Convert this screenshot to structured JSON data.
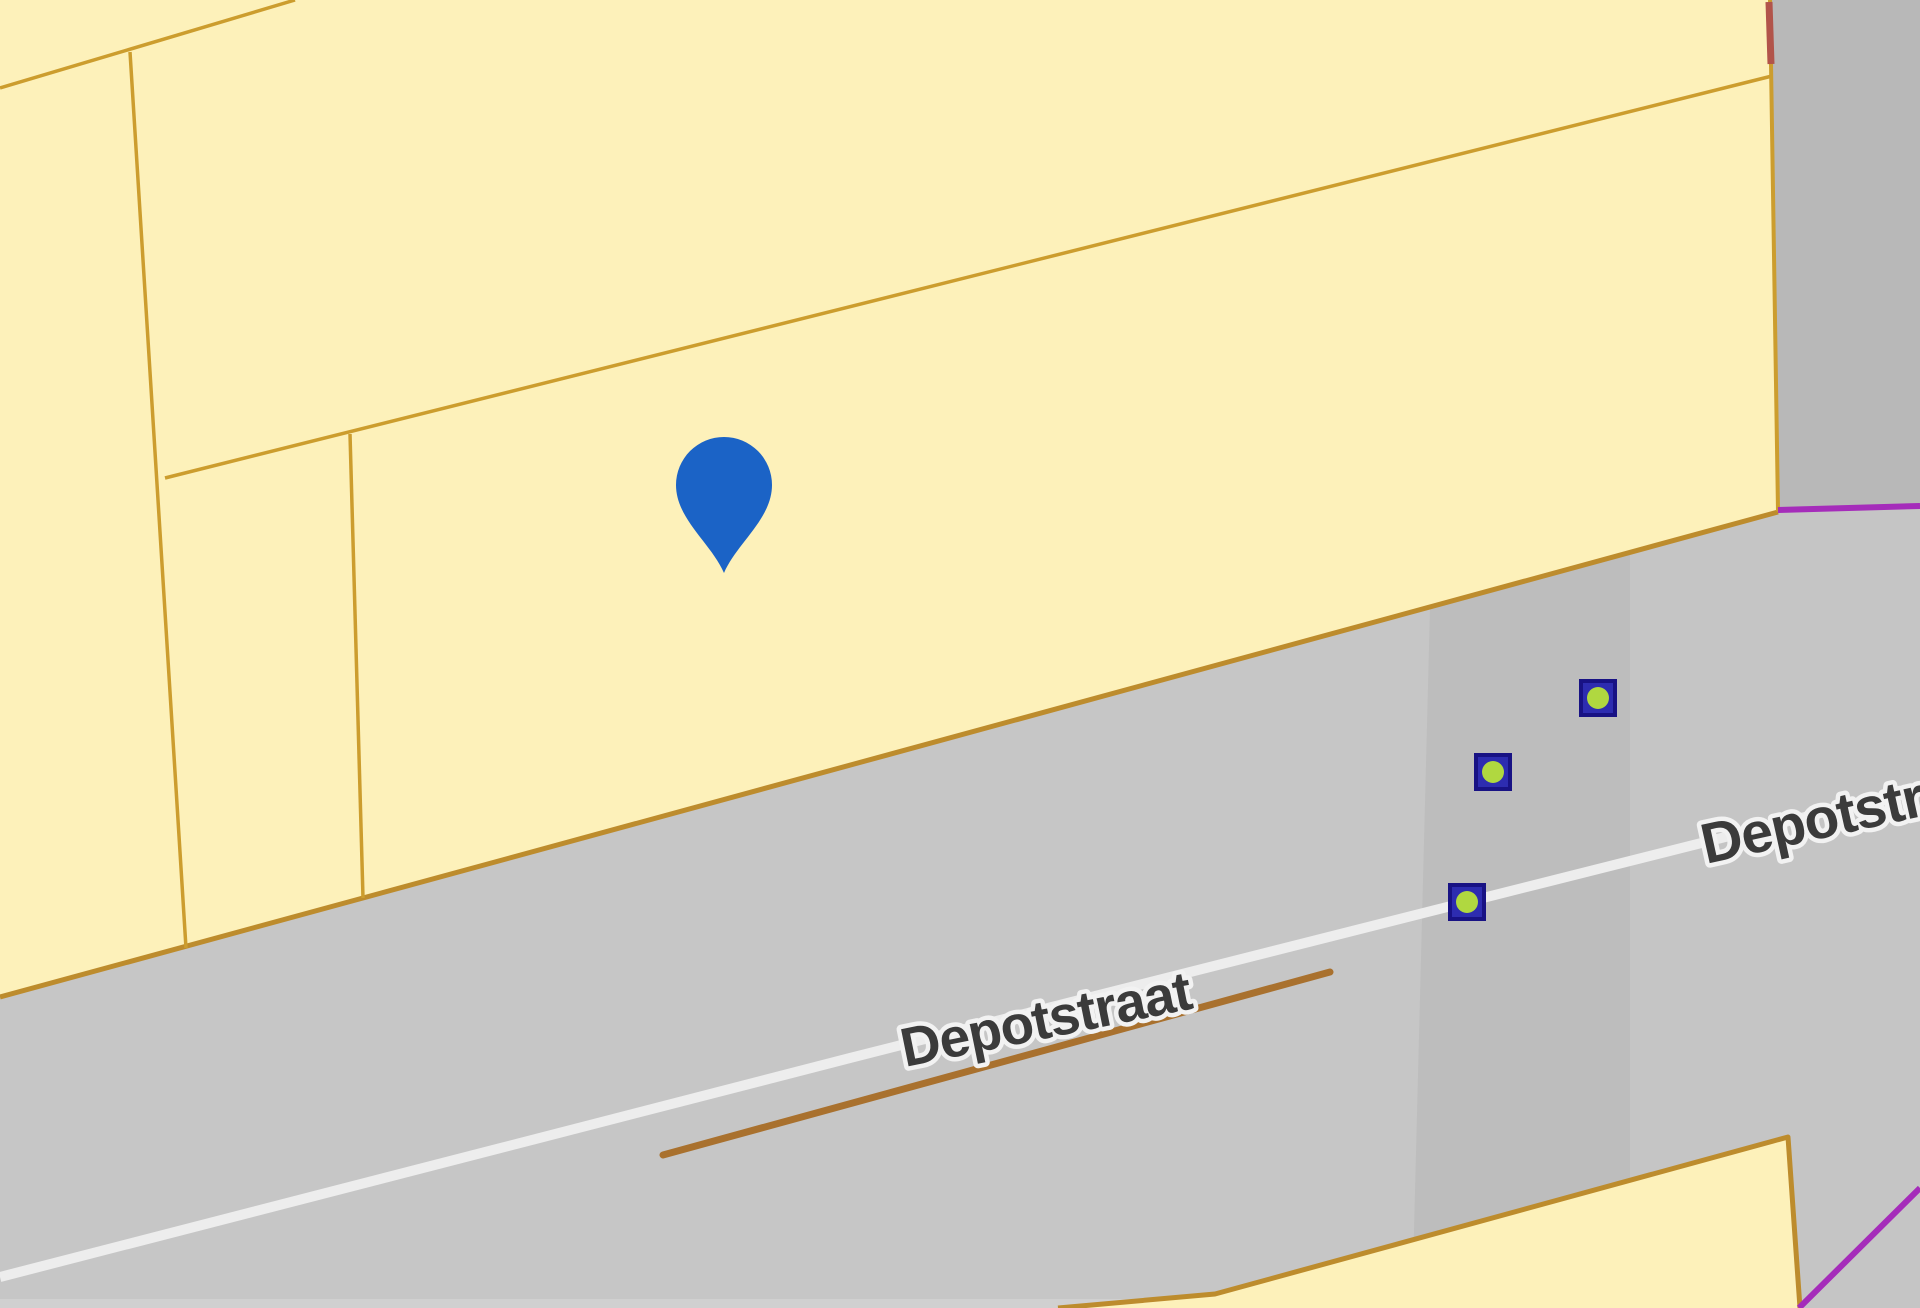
{
  "map": {
    "street_labels": [
      {
        "text": "Depotstraat",
        "x": 905,
        "y": 1067,
        "angle": -11.5
      },
      {
        "text": "Depotstraat",
        "x": 1706,
        "y": 864,
        "angle": -12.5
      }
    ],
    "pin": {
      "x": 724,
      "y": 573
    },
    "node_markers": [
      {
        "x": 1598,
        "y": 698
      },
      {
        "x": 1493,
        "y": 772
      },
      {
        "x": 1467,
        "y": 902
      }
    ],
    "colors": {
      "parcel_fill": "#fdf1ba",
      "parcel_border": "#cc9d2e",
      "road_edge_border": "#bd8c2d",
      "boundary_red": "#b2544a",
      "road_base": "#c6c6c6",
      "road_band_mid": "#bdbdbd",
      "road_band_right": "#c5c5c5",
      "road_topright": "#b8b8b8",
      "road_bottom_strip": "#d0d0d0",
      "centerline_white": "#ededed",
      "path_brown": "#a9712e",
      "boundary_purple": "#a52cba",
      "pin_blue": "#1b63c6",
      "marker_body": "#2d2cb0",
      "marker_outline": "#181284",
      "marker_dot": "#b0d840",
      "label_text": "#3b3b3b",
      "label_halo": "#f2f2f2"
    }
  }
}
